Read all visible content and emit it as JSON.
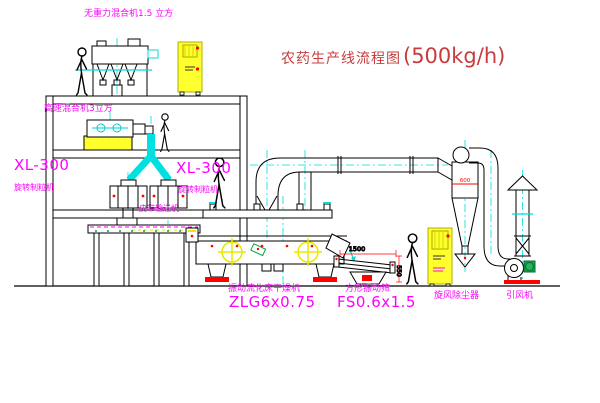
{
  "diagram": {
    "title": {
      "name": "农药生产线流程图",
      "capacity": "(500kg/h)"
    },
    "labels": {
      "gravity_mixer": "无重力混合机1.5 立方",
      "high_speed_mixer": "高速混合机3立方",
      "granulator_left_model": "XL-300",
      "granulator_left_name": "旋转制粒机",
      "granulator_right_model": "XL-300",
      "granulator_right_name": "旋转制粒机",
      "belt_conveyor": "皮带输送机",
      "dryer_name": "振动流化床干燥机",
      "dryer_model": "ZLG6x0.75",
      "screen_name": "方形振动筛",
      "screen_model": "FS0.6x1.5",
      "cyclone": "旋风除尘器",
      "fan": "引风机"
    },
    "dimensions": {
      "screen_length": "1500",
      "screen_height": "550",
      "cyclone_diameter": "600"
    },
    "colors": {
      "label_magenta": "#ff00ff",
      "title_red": "#c83c3c",
      "centerline_cyan": "#00dcdc",
      "cabinet_yellow": "#ffff00",
      "accent_red": "#ff0000",
      "motor_green": "#18a24c",
      "line_black": "#000000",
      "background": "#ffffff"
    }
  }
}
